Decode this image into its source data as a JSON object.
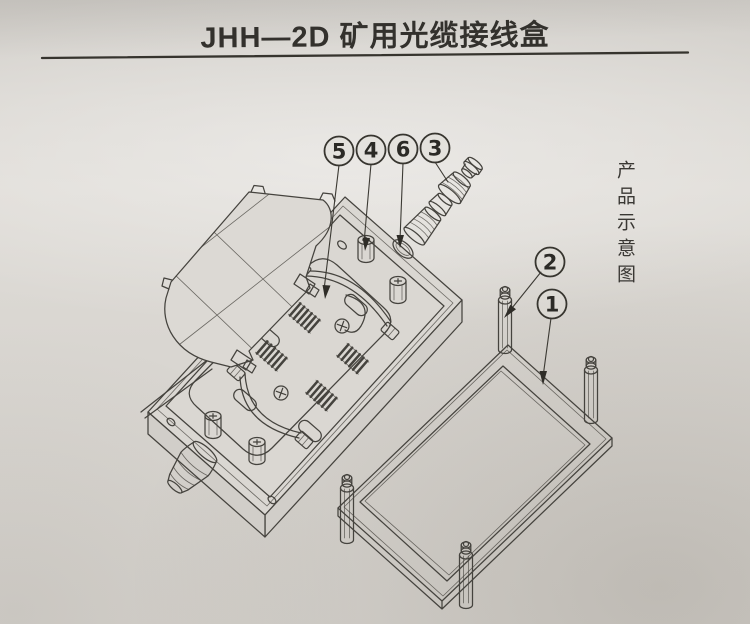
{
  "page": {
    "title": "JHH—2D 矿用光缆接线盒",
    "side_label": "产品示意图"
  },
  "callouts": [
    {
      "label": "5"
    },
    {
      "label": "4"
    },
    {
      "label": "6"
    },
    {
      "label": "3"
    },
    {
      "label": "2"
    },
    {
      "label": "1"
    }
  ],
  "colors": {
    "paper": "#d9d6d1",
    "line": "#45433e",
    "text": "#33312d"
  }
}
